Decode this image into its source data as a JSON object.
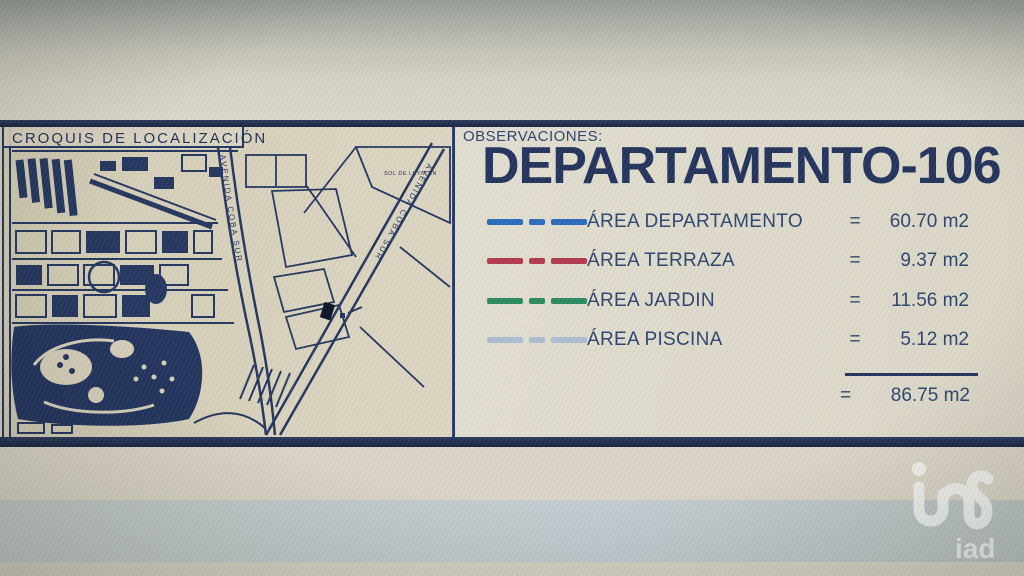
{
  "croquis": {
    "title": "CROQUIS DE LOCALIZACIÓN",
    "avenue_vertical": "AVENIDA COBA SUR",
    "avenue_diagonal": "AVENIDA COBA SUR",
    "block_label": "SOL DE LUYM SN"
  },
  "observations": {
    "label": "OBSERVACIONES:",
    "title": "DEPARTAMENTO-106",
    "legend": [
      {
        "name": "ÁREA DEPARTAMENTO",
        "eq": "=",
        "value": "60.70 m2",
        "color": "#2a6bbf"
      },
      {
        "name": "ÁREA TERRAZA",
        "eq": "=",
        "value": "9.37 m2",
        "color": "#b23a4e"
      },
      {
        "name": "ÁREA JARDIN",
        "eq": "=",
        "value": "11.56 m2",
        "color": "#2a8a5f"
      },
      {
        "name": "ÁREA PISCINA",
        "eq": "=",
        "value": "5.12 m2",
        "color": "#aebdd2"
      }
    ],
    "total": {
      "eq": "=",
      "value": "86.75 m2"
    }
  },
  "watermark": {
    "text": "iad"
  },
  "colors": {
    "ink_navy": "#24365f",
    "title_navy": "#22335c",
    "paper_beige": "#ddd8c9",
    "band_bluegray": "#c3cdd1"
  }
}
